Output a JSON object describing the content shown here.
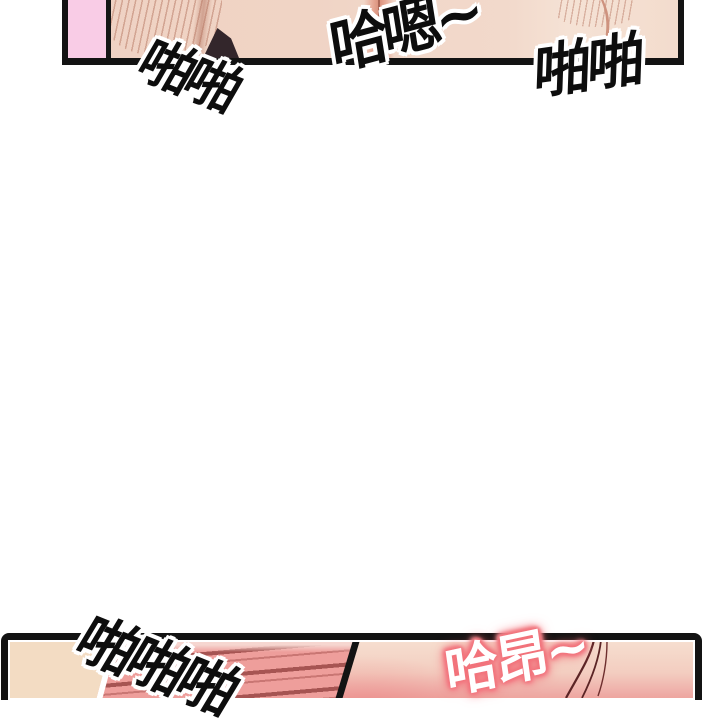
{
  "comic": {
    "sfx": {
      "top_left": "啪啪",
      "top_center": "哈嗯~",
      "top_right": "啪啪",
      "bottom_left": "啪啪啪",
      "bottom_right": "哈昂~"
    },
    "colors": {
      "panel_border": "#131313",
      "pink_block": "#F9CCE6",
      "skin_light": "#F2D6C7",
      "skin_highlight": "#F5E2D5",
      "skin_hatch": "#BB7E6A",
      "dark_wedge": "#33262B",
      "beige": "#F3DCC3",
      "stripe_background": "#EE9E9B",
      "stripe_dark": "#A65452",
      "blush_pink": "#EDA29C",
      "hair_strand": "#5B2425",
      "sfx_fill_black": "#0D0D0D",
      "sfx_outline_white": "#FFFFFF",
      "sfx_moan_fill": "#FFFFFF",
      "sfx_moan_glow": "#F0666E"
    }
  }
}
